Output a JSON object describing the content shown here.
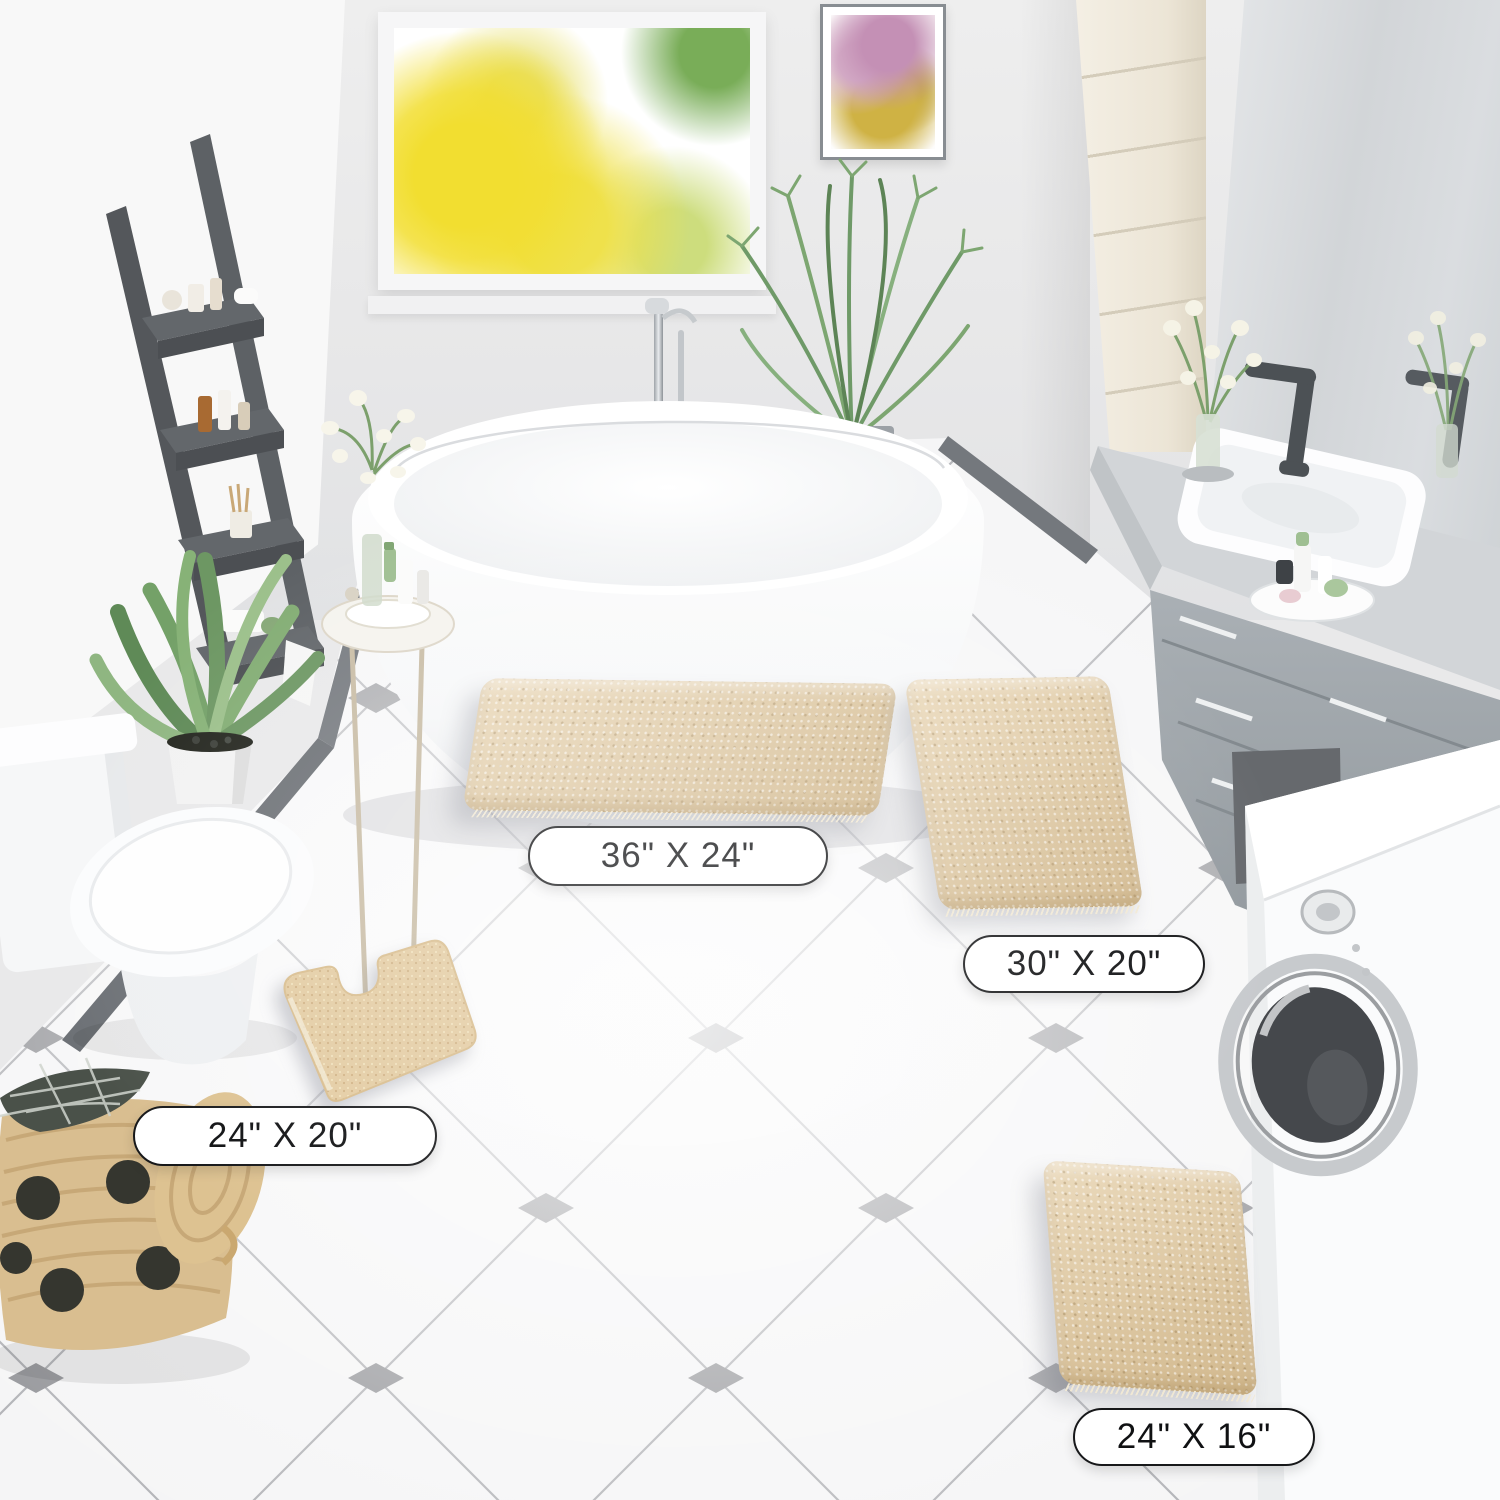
{
  "scene": {
    "description": "Bathroom product photo showing a four-piece beige chenille bath rug set on white diamond-pattern tile floor",
    "objects": [
      "window",
      "wall-art",
      "ladder-shelf",
      "potted-plant",
      "palm-plant",
      "freestanding-bathtub",
      "side-table",
      "toilet",
      "vanity-with-sink",
      "mirror",
      "tall-cabinet",
      "washing-machine",
      "laundry-basket"
    ]
  },
  "labels": {
    "rug_36x24": "36\" X 24\"",
    "rug_30x20": "30\" X 20\"",
    "rug_24x20": "24\" X 20\"",
    "rug_24x16": "24\" X 16\""
  },
  "palette": {
    "rug_beige": "#e3cba1",
    "floor_tile_white": "#f5f5f6",
    "tile_accent_gray": "#97989c",
    "wall_gray": "#e9e9ea",
    "vanity_gray": "#9aa1a6",
    "fixture_dark_gray": "#4c5155",
    "ladder_gray": "#56595d",
    "basket_tan": "#d9be90"
  }
}
